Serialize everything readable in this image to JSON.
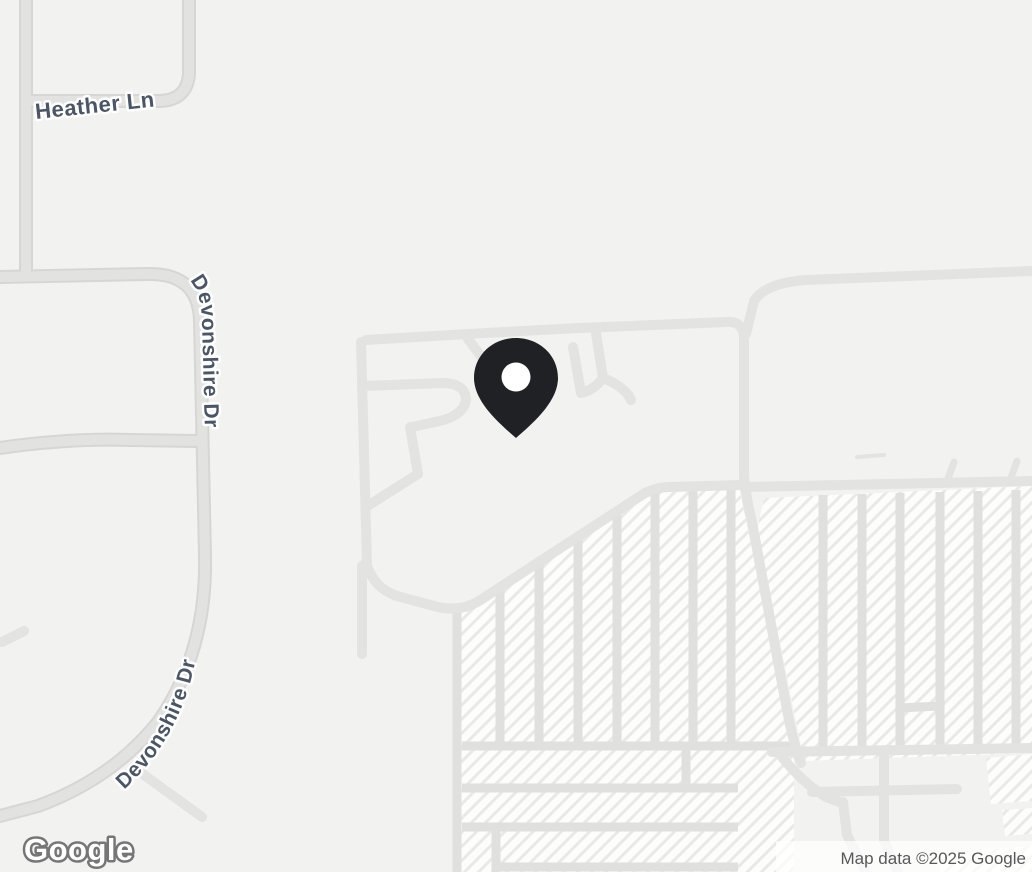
{
  "map": {
    "labels": {
      "heather_ln": "Heather Ln",
      "devonshire_dr_upper": "Devonshire Dr",
      "devonshire_dr_lower": "Devonshire Dr"
    },
    "marker": {
      "type": "location-pin"
    },
    "logo_text": "Google",
    "attribution": "Map data ©2025 Google"
  },
  "theme": {
    "map-bg": "#f2f2f0",
    "road-casing": "#d6d6d4",
    "road-fill": "#e2e2e0",
    "minor-road": "#e3e3e1",
    "parking-fill": "#fdfdfc",
    "parking-hatch": "#e9e9e7",
    "aisle-line": "#e0e0de",
    "label-color": "#4a5668",
    "label-halo": "#ffffff",
    "pin-color": "#202124",
    "pin-hole": "#ffffff",
    "logo-fill": "#ffffff",
    "logo-outline": "#767676",
    "attribution-color": "#58585a",
    "attribution-bg": "rgba(255,255,255,0.72)"
  }
}
